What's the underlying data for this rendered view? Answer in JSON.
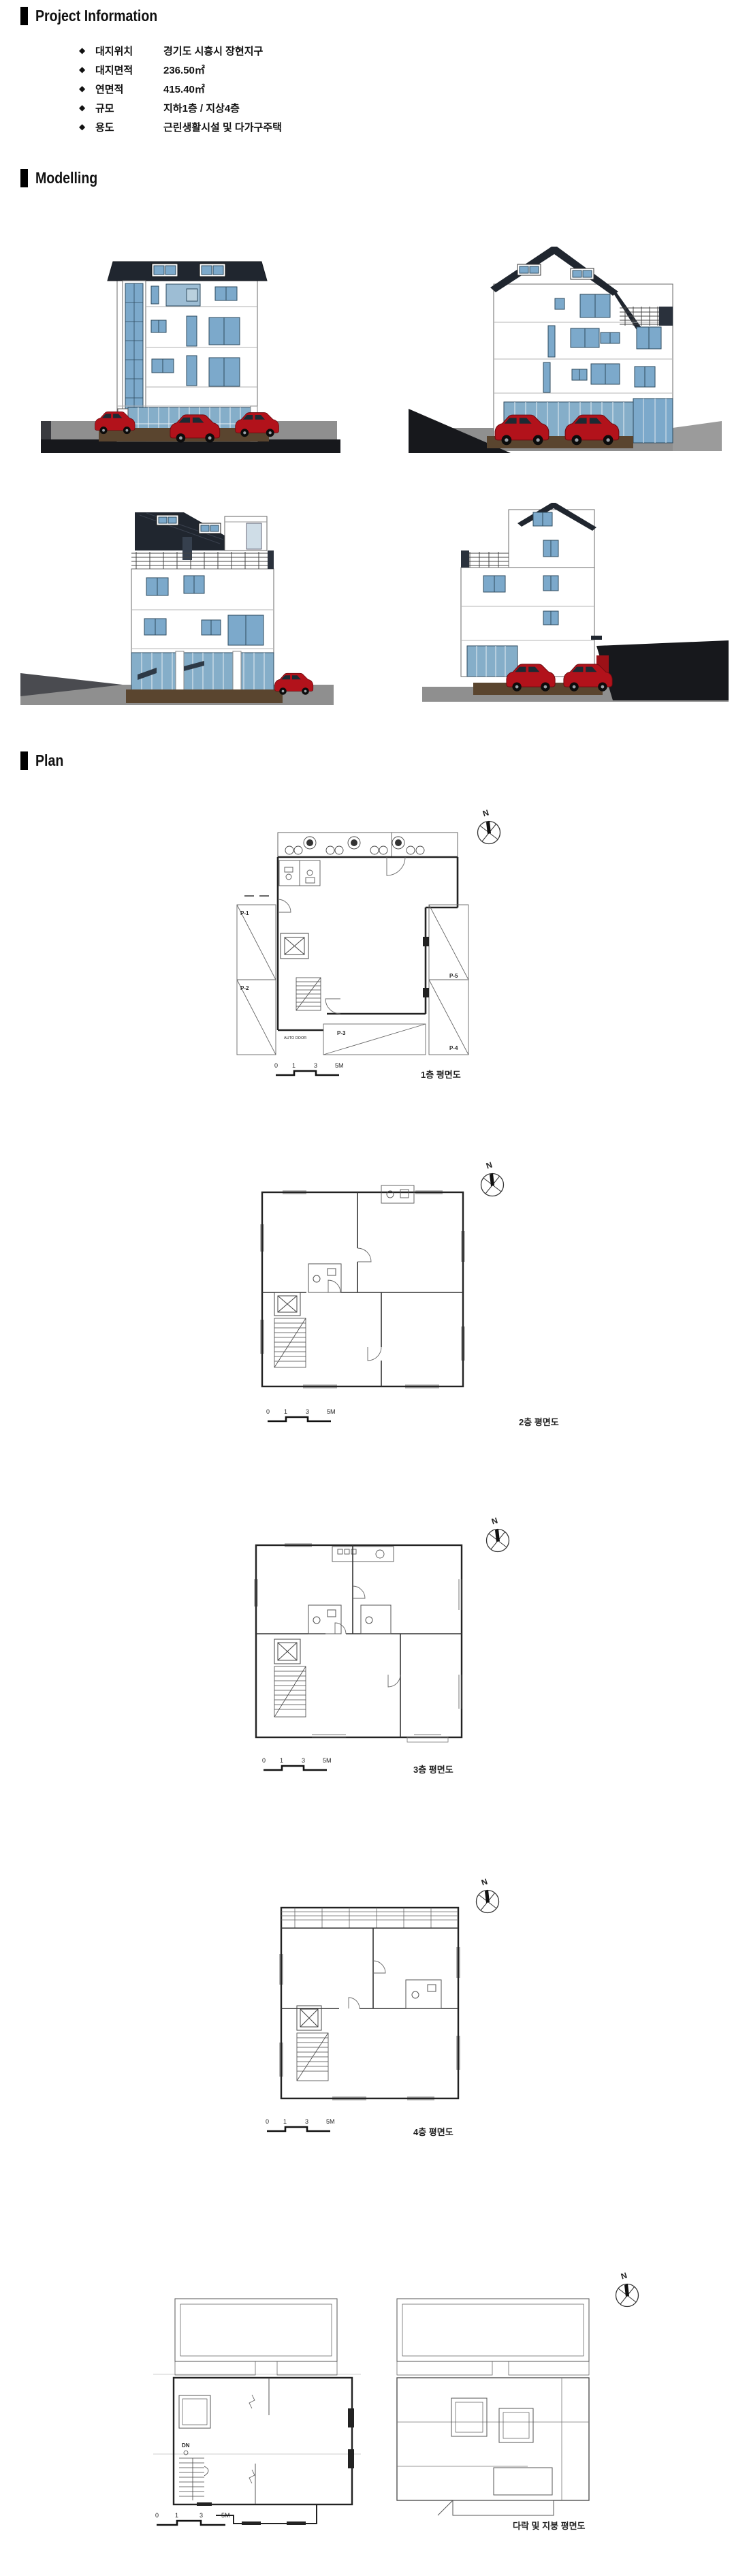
{
  "document": {
    "sections": {
      "project_info": {
        "title": "Project Information",
        "bullet": "◆",
        "items": [
          {
            "label": "대지위치",
            "value": "경기도 시흥시 장현지구"
          },
          {
            "label": "대지면적",
            "value": "236.50㎡"
          },
          {
            "label": "연면적",
            "value": "415.40㎡"
          },
          {
            "label": "규모",
            "value": "지하1층 / 지상4층"
          },
          {
            "label": "용도",
            "value": "근린생활시설 및 다가구주택"
          }
        ]
      },
      "modelling": {
        "title": "Modelling",
        "views": [
          {
            "name": "front elevation render"
          },
          {
            "name": "right side elevation render"
          },
          {
            "name": "rear elevation render"
          },
          {
            "name": "left side elevation render"
          }
        ]
      },
      "plan": {
        "title": "Plan",
        "compass_label": "N",
        "scale_ticks": [
          "0",
          "1",
          "3",
          "5M"
        ],
        "floors": [
          {
            "label": "1층 평면도",
            "annotations": {
              "parking": [
                "P-1",
                "P-2",
                "P-3",
                "P-4",
                "P-5"
              ],
              "auto_door": "AUTO DOOR"
            }
          },
          {
            "label": "2층 평면도"
          },
          {
            "label": "3층 평면도"
          },
          {
            "label": "4층 평면도"
          },
          {
            "label": "다락 및 지붕 평면도",
            "annotations": {
              "down": "DN"
            }
          }
        ]
      }
    },
    "colors": {
      "roof_dark": "#20262f",
      "window_blue": "#7ca9cb",
      "storefront_blue": "#85aec9",
      "car_red": "#b2121b",
      "ground_gray": "#8f8f8f",
      "road_dark": "#17181c",
      "dirt_brown": "#5a452f"
    }
  }
}
